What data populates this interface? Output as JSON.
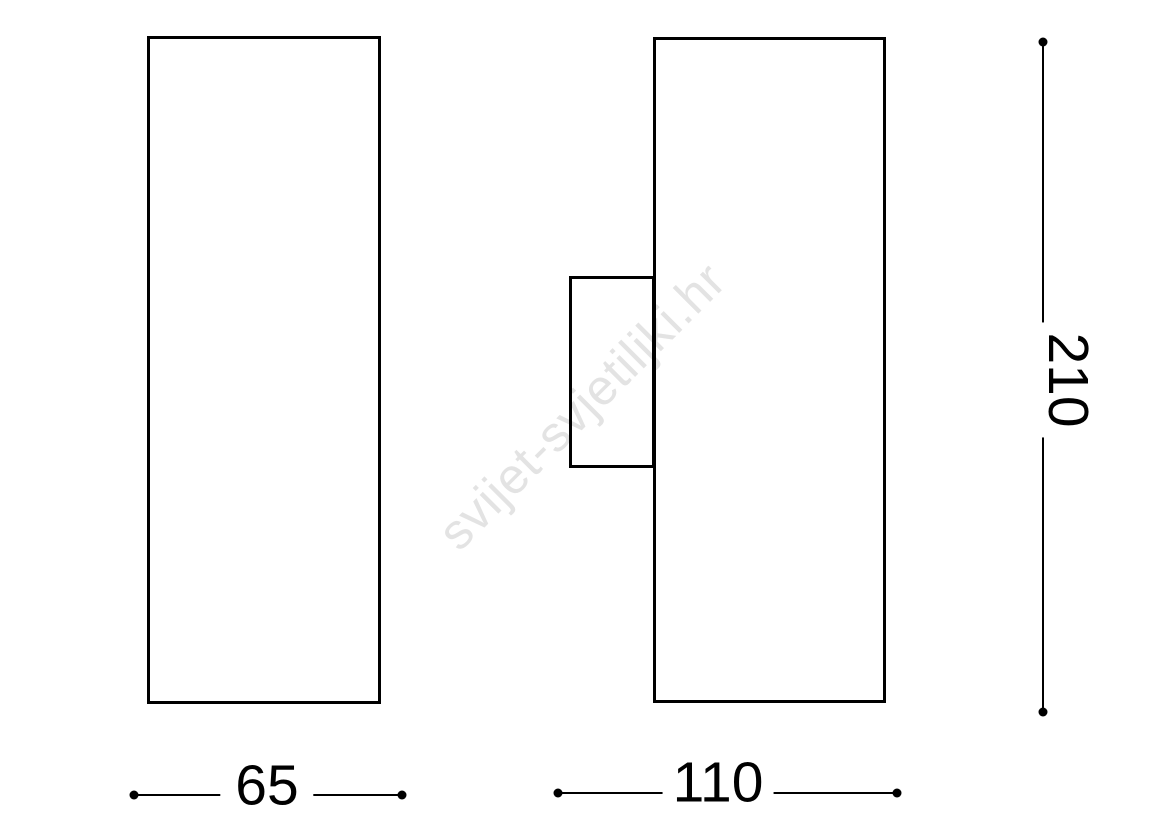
{
  "watermark": {
    "text": "svijet-svjetiljki.hr"
  },
  "drawing": {
    "type": "technical-dimension-drawing",
    "views": {
      "front": "tall rectangle (front view of cylinder wall lamp)",
      "side": "tall rectangle with wall-mount bracket on left (side view)"
    },
    "dimensions": {
      "front_width": {
        "value": "65"
      },
      "side_width": {
        "value": "110"
      },
      "height": {
        "value": "210"
      }
    }
  },
  "colors": {
    "line": "#000000",
    "background": "#ffffff",
    "watermark": "#e3e3e3"
  }
}
